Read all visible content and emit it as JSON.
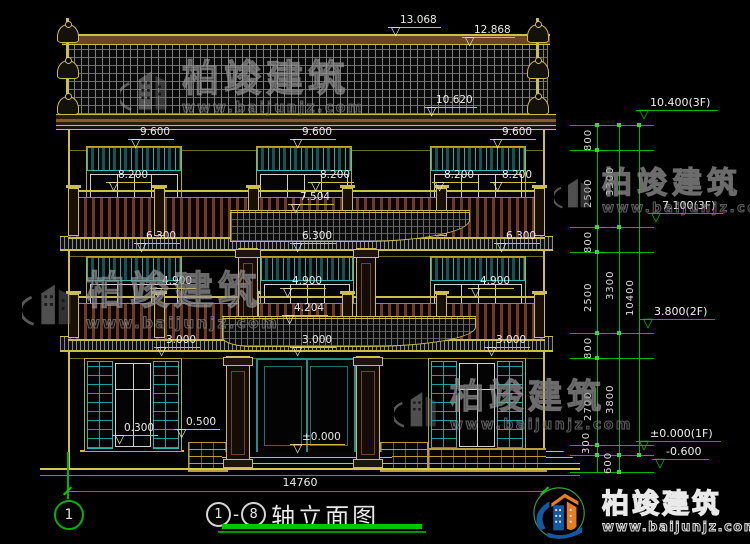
{
  "title": {
    "axis_start": "1",
    "dash": "-",
    "axis_end": "8",
    "name": "轴立面图"
  },
  "brand": {
    "name": "柏竣建筑",
    "url": "www.baijunjz.com"
  },
  "watermark": {
    "name": "柏竣建筑",
    "url": "www.baijunjz.com"
  },
  "ground_dim": {
    "total_width": "14760",
    "axis_label": "1"
  },
  "levels": {
    "roof": "10.400(3F)",
    "f3": "7.100(3F)",
    "f2": "3.800(2F)",
    "f1": "±0.000(1F)",
    "site": "-0.600"
  },
  "chains": {
    "a": [
      "800",
      "2500",
      "800",
      "2500",
      "800",
      "2700",
      "300"
    ],
    "b": [
      "3300",
      "3300",
      "3800",
      "600"
    ],
    "c": [
      "10400"
    ]
  },
  "elev": {
    "ridge": "13.068",
    "roof_edge": "12.868",
    "eave": "10.620",
    "f3_win_top": "9.600",
    "f3_rail": "8.200",
    "f2_porch_roof": "7.504",
    "f2_win_top": "6.300",
    "f2_rail": "4.900",
    "f1_porch_roof": "4.204",
    "f1_win_top": "3.000",
    "f1_sill": "0.300",
    "f1_plat": "0.500",
    "f1_floor": "±0.000"
  },
  "icons": {
    "level_triangle": "▽"
  },
  "colors": {
    "cad_yellow": "#cdbd49",
    "cad_green": "#00b400",
    "window_cyan": "#28b6b6",
    "rail_brown": "#6e3a26"
  }
}
